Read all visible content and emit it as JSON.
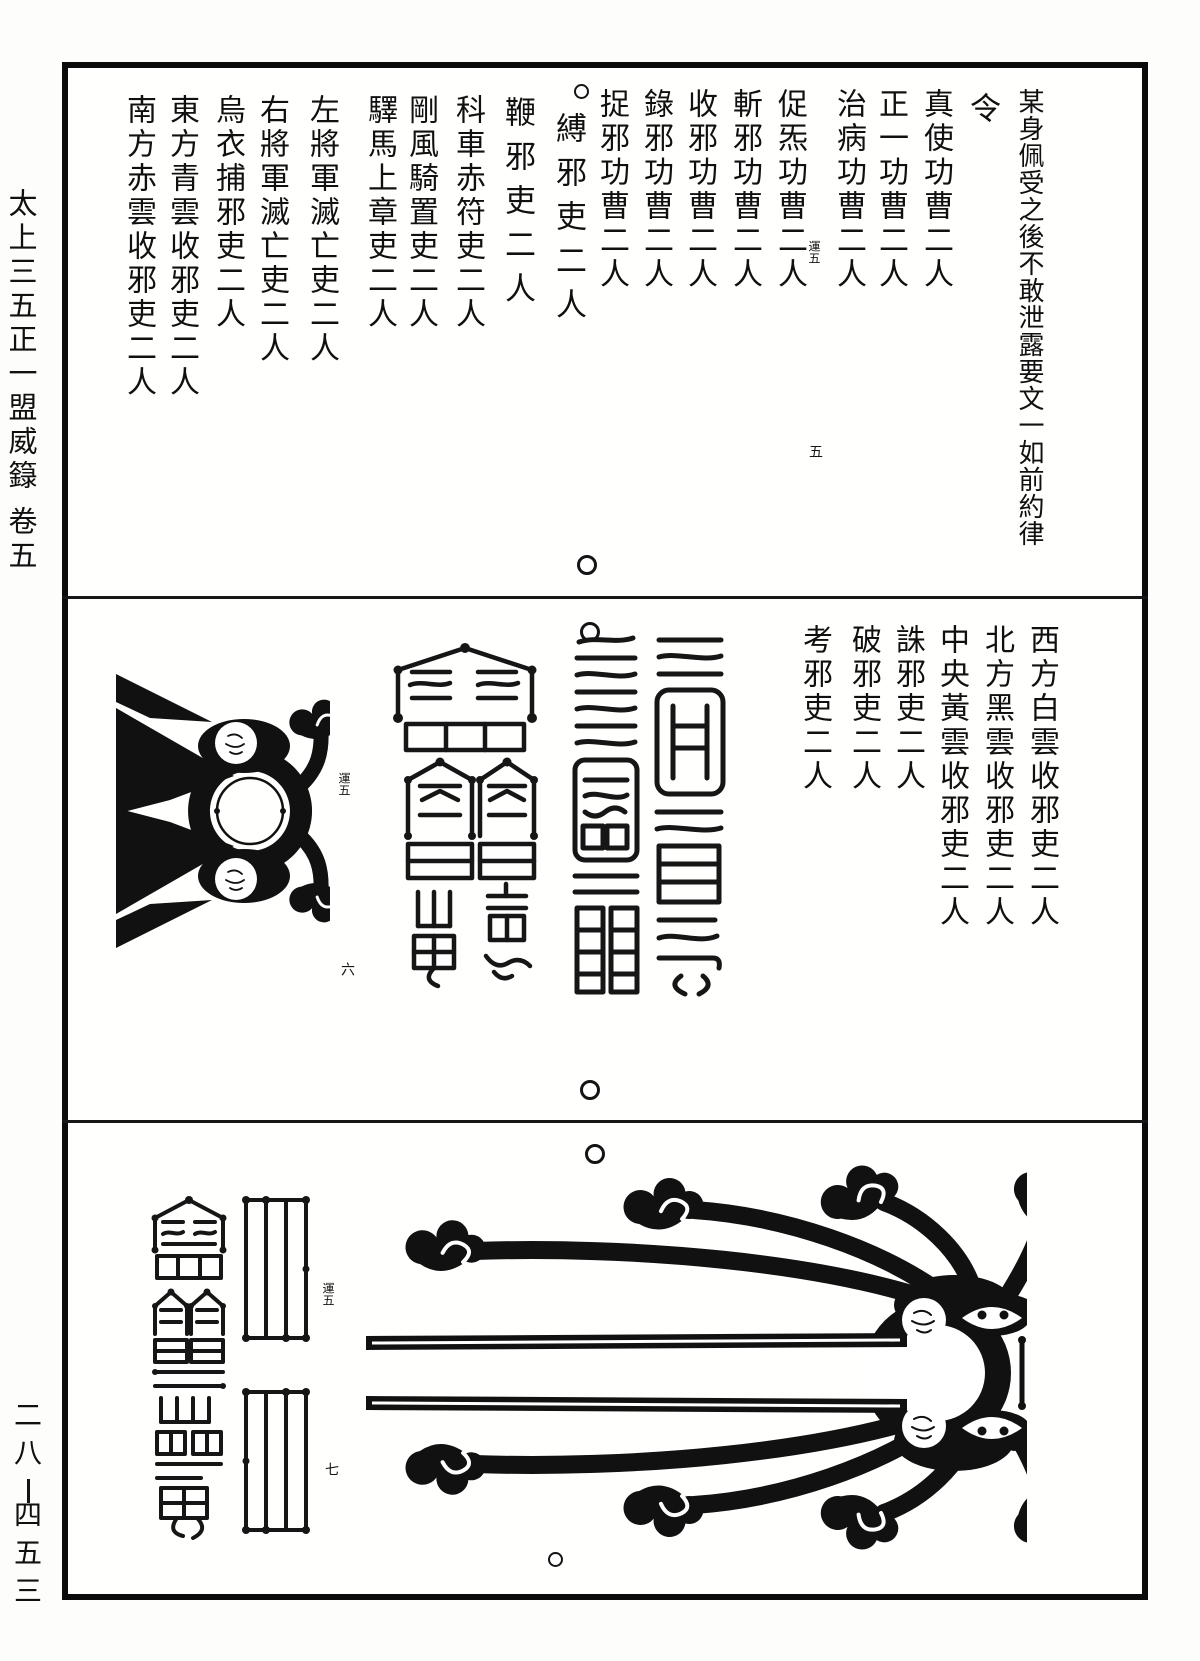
{
  "page": {
    "spine_title": "太上三五正一盟威籙",
    "spine_volume": "卷五",
    "catalog_number_top": "二八",
    "catalog_number_bottom": "四五三"
  },
  "sections": {
    "top": {
      "columns": [
        "某身佩受之後不敢泄露要文一如前約律",
        "令",
        "真使功曹二人",
        "正一功曹二人",
        "治病功曹二人",
        "促炁功曹二人",
        "斬邪功曹二人",
        "收邪功曹二人",
        "錄邪功曹二人",
        "捉邪功曹二人",
        "縛邪吏二人",
        "鞭邪吏二人",
        "科車赤符吏二人",
        "剛風騎置吏二人",
        "驛馬上章吏二人",
        "左將軍滅亡吏二人",
        "右將軍滅亡吏二人",
        "烏衣捕邪吏二人",
        "東方青雲收邪吏二人",
        "南方赤雲收邪吏二人"
      ],
      "banxin": {
        "label": "運五",
        "leaf": "五"
      }
    },
    "middle": {
      "columns": [
        "西方白雲收邪吏二人",
        "北方黑雲收邪吏二人",
        "中央黃雲收邪吏二人",
        "誅邪吏二人",
        "破邪吏二人",
        "考邪吏二人"
      ],
      "banxin": {
        "label": "運五",
        "leaf": "六"
      }
    },
    "bottom": {
      "banxin": {
        "label": "運五",
        "leaf": "七"
      }
    }
  },
  "figures": {
    "middle_serpentine_talisman": "seal-script-talisman",
    "middle_pagoda_talisman": "pagoda-seal-talisman",
    "middle_cloud_emblem": "cloud-scroll-ring-emblem",
    "bottom_tall_talisman": "tall-pagoda-seal-talisman",
    "bottom_line_talismans": "vertical-line-grid-talismans",
    "bottom_cloud_figure": "large-cloud-scroll-emblem"
  },
  "marks": {
    "fisheye_circle": "○"
  }
}
